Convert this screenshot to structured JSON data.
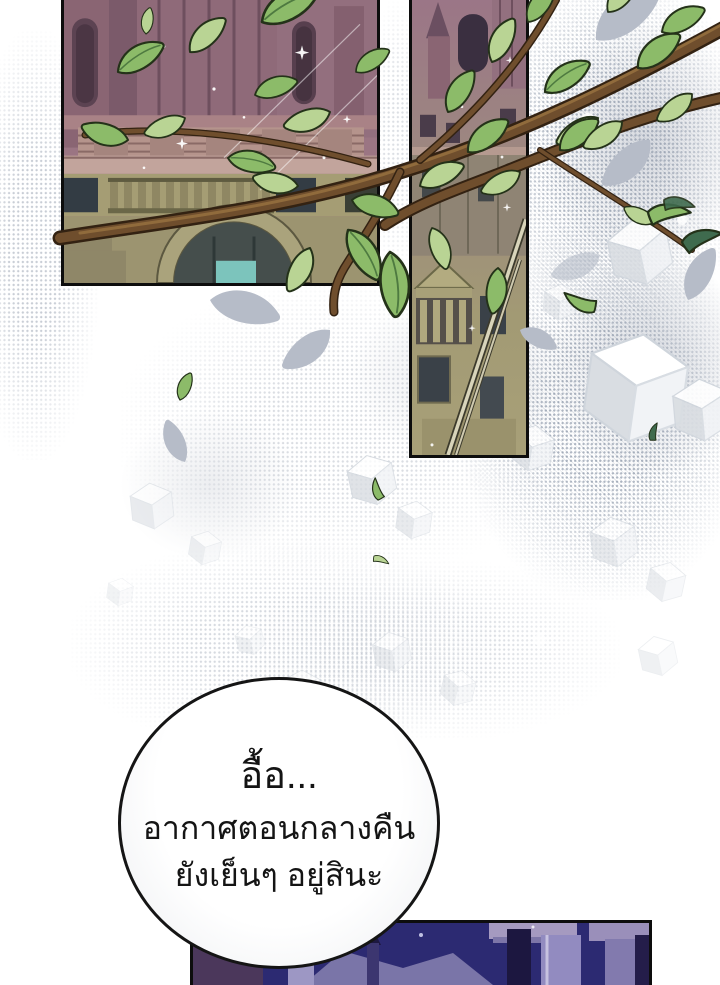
{
  "page": {
    "type": "webtoon-comic-page"
  },
  "speech_bubble": {
    "lines": [
      "อื้อ...",
      "อากาศตอนกลางคืน",
      "ยังเย็นๆ อยู่สินะ"
    ]
  },
  "palette": {
    "leaf_light": "#b9d494",
    "leaf_mid": "#8cbb69",
    "leaf_teal": "#3f6b4e",
    "leaf_outline": "#243219",
    "branch_brown": "#6f4e2d",
    "branch_dark": "#332212",
    "branch_light": "#97713f",
    "castle_mauve": "#96707e",
    "olive_wall": "#a19a73",
    "teal_accent": "#7cc4bc",
    "night_navy": "#2c2a72",
    "night_lavender": "#918bbd",
    "bubble_border": "#151515",
    "panel_border": "#0d0d0d",
    "halftone_dot": "#68768c"
  }
}
